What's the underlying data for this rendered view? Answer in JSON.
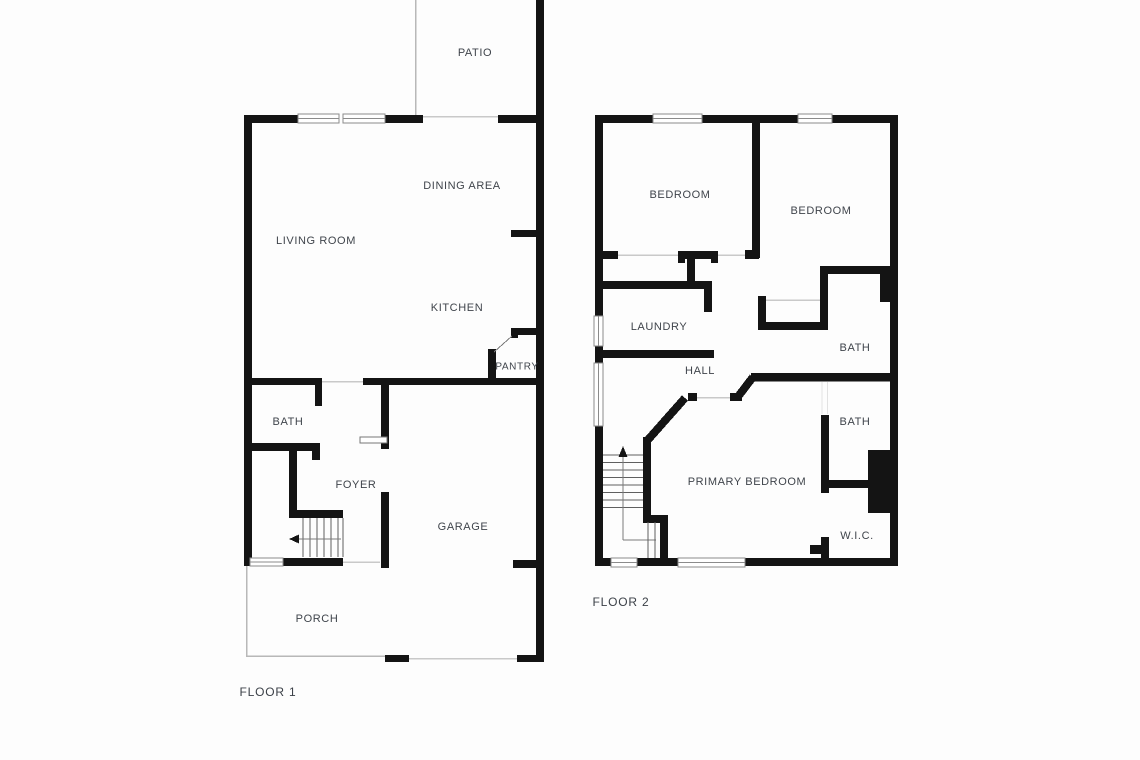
{
  "floor1": {
    "title": "FLOOR 1",
    "rooms": {
      "patio": "PATIO",
      "dining_area": "DINING AREA",
      "living_room": "LIVING ROOM",
      "kitchen": "KITCHEN",
      "pantry": "PANTRY",
      "bath": "BATH",
      "foyer": "FOYER",
      "garage": "GARAGE",
      "porch": "PORCH"
    }
  },
  "floor2": {
    "title": "FLOOR 2",
    "rooms": {
      "bedroom_left": "BEDROOM",
      "bedroom_right": "BEDROOM",
      "laundry": "LAUNDRY",
      "hall": "HALL",
      "bath_upper": "BATH",
      "bath_lower": "BATH",
      "primary_bedroom": "PRIMARY BEDROOM",
      "wic": "W.I.C."
    }
  },
  "colors": {
    "wall": "#141414",
    "background": "#fdfdfd",
    "label_text": "#3f444b"
  }
}
